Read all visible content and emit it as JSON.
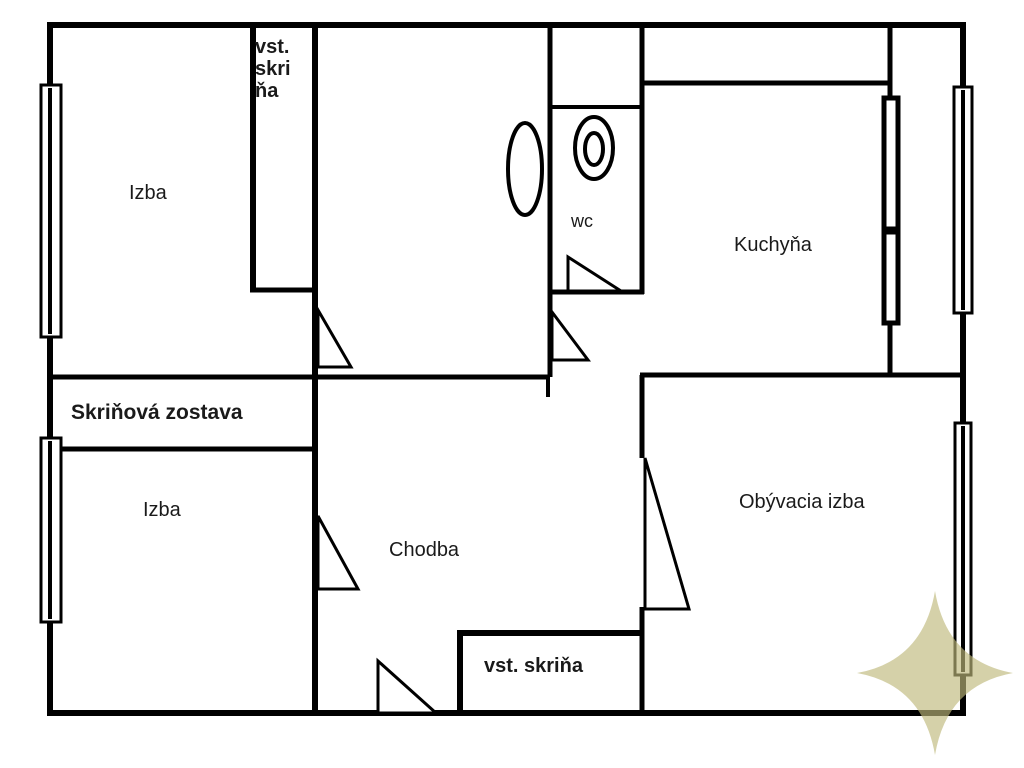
{
  "plan": {
    "background_color": "#ffffff",
    "line_color": "#000000"
  },
  "rooms": {
    "izba_top": {
      "label": "Izba"
    },
    "vstavana_skrina_top": {
      "lines": [
        "vst.",
        "skri",
        "ňa"
      ]
    },
    "wc": {
      "label": "wc"
    },
    "kuchyna": {
      "label": "Kuchyňa"
    },
    "skrinova_zostava": {
      "label": "Skriňová zostava"
    },
    "izba_bottom": {
      "label": "Izba"
    },
    "chodba": {
      "label": "Chodba"
    },
    "obyvacia_izba": {
      "label": "Obývacia izba"
    },
    "vstavana_skrina_bottom": {
      "label": "vst. skriňa"
    }
  },
  "fixtures": {
    "bathtub": "bathtub",
    "toilet": "toilet"
  },
  "watermark": {
    "color": "#beb97b",
    "opacity": "0.65"
  }
}
